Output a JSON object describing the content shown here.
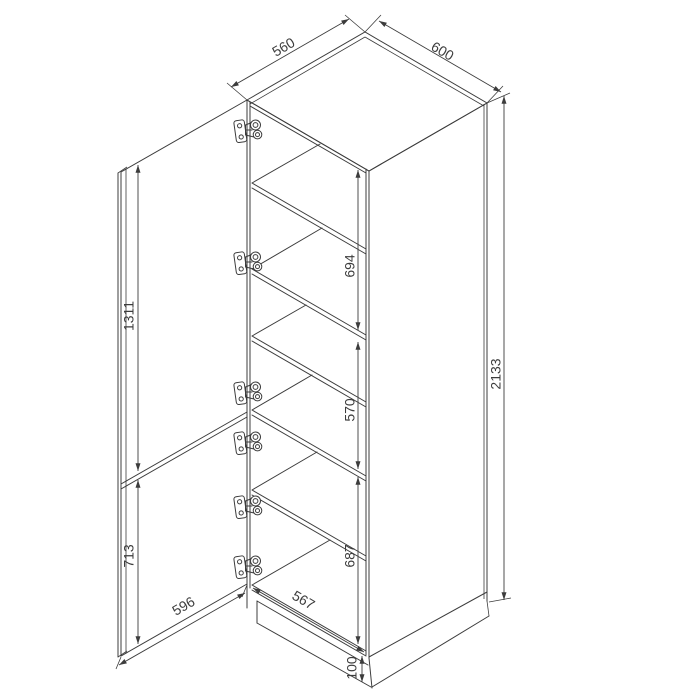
{
  "drawing": {
    "background": "#ffffff",
    "line_color": "#3c3c3c",
    "dimensions": {
      "top_depth": "560",
      "top_width": "600",
      "section_upper": "694",
      "door_upper": "1311",
      "section_middle": "570",
      "height_total": "2133",
      "door_lower": "713",
      "section_lower": "687",
      "door_width": "596",
      "width_inner": "567",
      "plinth": "100"
    }
  }
}
